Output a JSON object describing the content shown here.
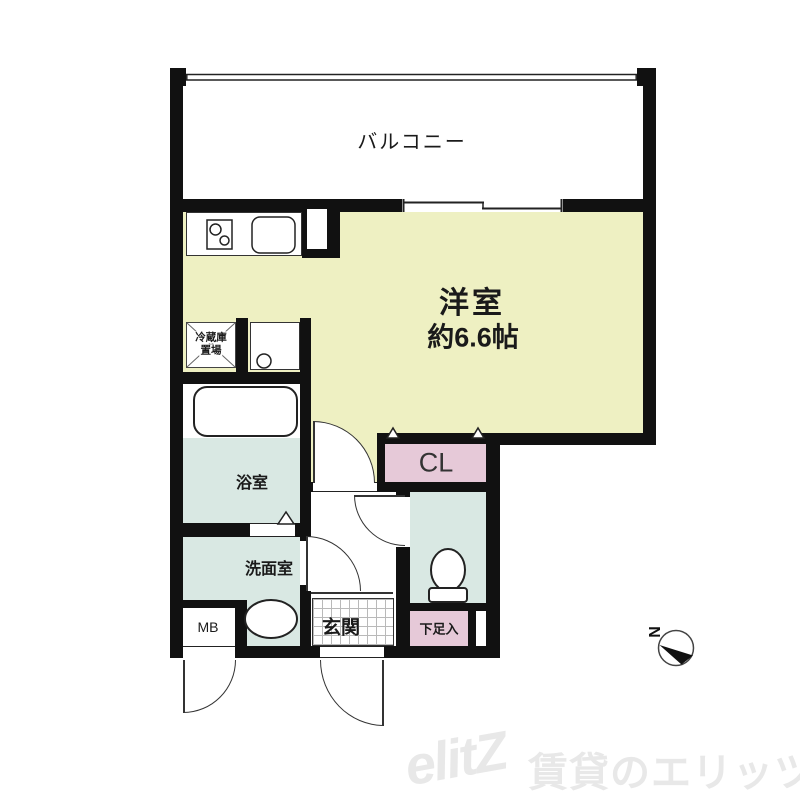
{
  "floorplan": {
    "balcony": {
      "label": "バルコニー"
    },
    "main_room": {
      "label": "洋室",
      "size": "約6.6帖"
    },
    "closet": {
      "label": "CL"
    },
    "bathroom": {
      "label": "浴室"
    },
    "washroom": {
      "label": "洗面室"
    },
    "entrance": {
      "label": "玄関"
    },
    "shoe_cabinet": {
      "label": "下足入"
    },
    "meter_box": {
      "label": "MB"
    },
    "refrigerator_space": {
      "label_line1": "冷蔵庫",
      "label_line2": "置場"
    },
    "compass": {
      "north_label": "N"
    },
    "fixtures": {
      "stove_icon": "two-burner-stove",
      "sink_icon": "kitchen-sink",
      "bathtub_icon": "bathtub",
      "washer_icon": "washing-machine-pan",
      "basin_icon": "wash-basin",
      "toilet_icon": "toilet",
      "window_icon": "sliding-window",
      "railing_icon": "balcony-railing"
    },
    "colors": {
      "room_yellow": "#eef0c2",
      "wet_area_blue": "#d9e8e3",
      "storage_pink": "#e6c9d8",
      "wall_black": "#111111",
      "watermark_gray": "#e8e8e8"
    }
  },
  "watermark": {
    "logo": "elitZ",
    "text": "賃貸のエリッツ"
  }
}
